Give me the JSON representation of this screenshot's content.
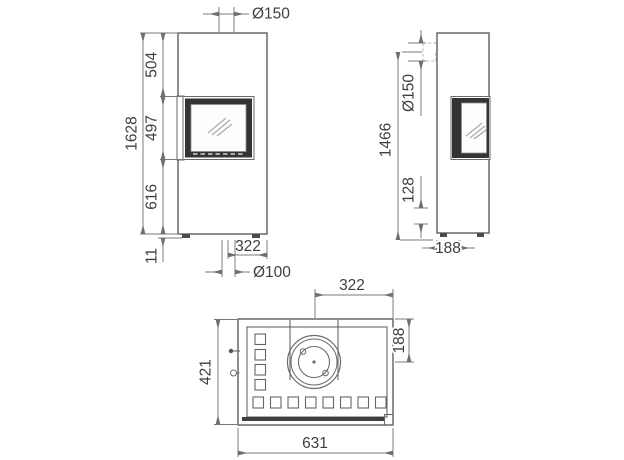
{
  "drawing": {
    "type": "stove-three-view-dimension-drawing",
    "front_view": {
      "dims": {
        "flue_diameter_top": "Ø150",
        "overall_height": "1628",
        "top_to_window": "504",
        "window_height": "497",
        "window_to_base": "616",
        "foot_height": "11",
        "pipe_center_to_edge": "322",
        "air_inlet_diameter": "Ø100"
      }
    },
    "side_view": {
      "dims": {
        "rear_flue_center_height": "1466",
        "flue_diameter_rear": "Ø150",
        "air_pipe_height": "128",
        "air_pipe_center_to_face": "188"
      }
    },
    "top_view": {
      "dims": {
        "flue_center_to_side": "322",
        "flue_center_to_back": "188",
        "depth": "421",
        "width": "631"
      }
    }
  }
}
